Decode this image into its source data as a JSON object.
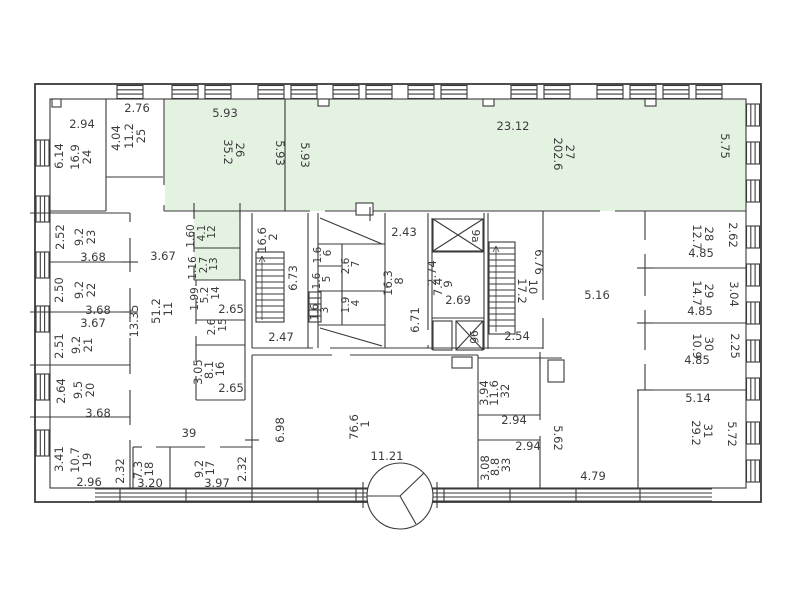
{
  "document": {
    "type": "floor-plan"
  },
  "colors": {
    "highlight": "#e4f2e2",
    "wall": "#3a3a3a",
    "text": "#3c3c3c"
  },
  "rooms": {
    "1": {
      "num": "1",
      "area": "76.6",
      "w": "11.21",
      "h": "6.98"
    },
    "2": {
      "num": "2",
      "area": "16.6",
      "h": "6.73",
      "w": "2.47"
    },
    "3": {
      "num": "3",
      "area": "1.6"
    },
    "4": {
      "num": "4",
      "area": "1.9"
    },
    "5": {
      "num": "5",
      "area": "1.6"
    },
    "6": {
      "num": "6",
      "area": "1.6"
    },
    "7": {
      "num": "7",
      "area": "2.6"
    },
    "8": {
      "num": "8",
      "area": "16.3",
      "w": "2.43",
      "h": "6.71"
    },
    "9": {
      "num": "9",
      "area": "7.4",
      "w": "2.74",
      "b": "2.69"
    },
    "9a": {
      "num": "9а"
    },
    "9b": {
      "num": "9б"
    },
    "10": {
      "num": "10",
      "area": "17.2",
      "w": "2.54",
      "len": "6.76"
    },
    "11": {
      "num": "11",
      "area": "51.2",
      "len": "13.35",
      "w": "3.67"
    },
    "12": {
      "num": "12",
      "area": "4.1",
      "h": "1.60"
    },
    "13": {
      "num": "13",
      "area": "2.7",
      "h": "1.16"
    },
    "14": {
      "num": "14",
      "area": "5.2",
      "h": "1.99",
      "b": "2.65"
    },
    "15": {
      "num": "15",
      "area": "2.6"
    },
    "16": {
      "num": "16",
      "area": "8.1",
      "h": "3.05",
      "b": "2.65"
    },
    "17": {
      "num": "17",
      "area": "9.2",
      "b": "3.97",
      "side": "2.32"
    },
    "18": {
      "num": "18",
      "area": "7.3",
      "b": "3.20",
      "side": "2.32"
    },
    "19": {
      "num": "19",
      "area": "10.7",
      "h": "3.41",
      "b": "2.96"
    },
    "20": {
      "num": "20",
      "area": "9.5",
      "h": "2.64",
      "b": "3.68"
    },
    "21": {
      "num": "21",
      "area": "9.2",
      "h": "2.51",
      "t": "3.67"
    },
    "22": {
      "num": "22",
      "area": "9.2",
      "h": "2.50",
      "b": "3.68"
    },
    "23": {
      "num": "23",
      "area": "9.2",
      "h": "2.52",
      "b": "3.68"
    },
    "24": {
      "num": "24",
      "area": "16.9",
      "w": "2.94",
      "h": "6.14"
    },
    "25": {
      "num": "25",
      "area": "11.2",
      "w": "2.76",
      "h": "4.04"
    },
    "26": {
      "num": "26",
      "area": "35.2",
      "w": "5.93",
      "h": "5.93"
    },
    "27": {
      "num": "27",
      "area": "202.6",
      "w": "23.12",
      "h": "5.75",
      "h2": "5.93"
    },
    "28": {
      "num": "28",
      "area": "12.7",
      "h": "2.62",
      "b": "4.85"
    },
    "29": {
      "num": "29",
      "area": "14.7",
      "h": "3.04",
      "b": "4.85"
    },
    "30": {
      "num": "30",
      "area": "10.9",
      "h": "2.25",
      "b": "4.85"
    },
    "31": {
      "num": "31",
      "area": "29.2",
      "t": "5.14",
      "h": "5.72"
    },
    "32": {
      "num": "32",
      "area": "11.6",
      "h": "3.94"
    },
    "33": {
      "num": "33",
      "area": "8.8",
      "h": "3.08"
    },
    "39": {
      "num": "39"
    }
  },
  "halls": {
    "main": "5.16",
    "w": "4.79",
    "h": "5.62",
    "vest_top": "2.94",
    "vest_bottom": "2.94"
  }
}
